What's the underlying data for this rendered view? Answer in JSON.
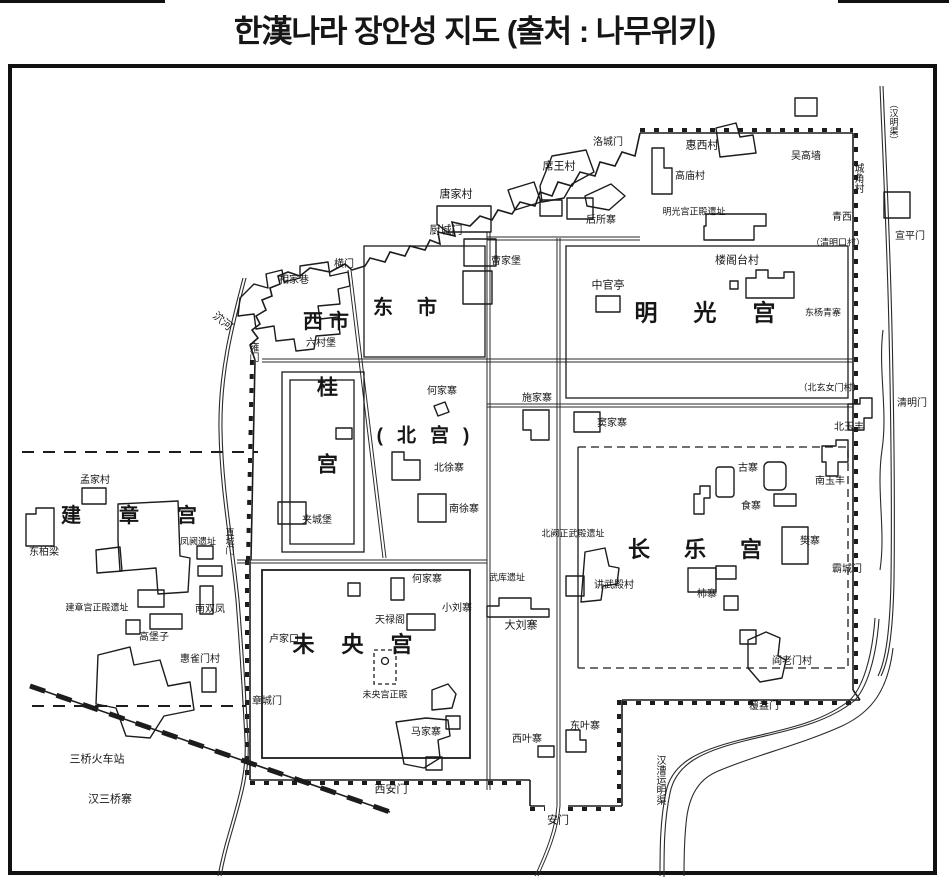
{
  "title": "한漢나라 장안성 지도 (출처 : 나무위키)",
  "colors": {
    "ink": "#1c1c1c",
    "frame": "#111111",
    "background": "#ffffff"
  },
  "map": {
    "labels": [
      {
        "t": "明光宫",
        "x": 723,
        "y": 313,
        "fs": 23,
        "ls": 36,
        "b": 1
      },
      {
        "t": "长乐宫",
        "x": 712,
        "y": 550,
        "fs": 22,
        "ls": 34,
        "b": 1
      },
      {
        "t": "未央宫",
        "x": 366,
        "y": 645,
        "fs": 22,
        "ls": 27,
        "b": 1
      },
      {
        "t": "建章宫",
        "x": 148,
        "y": 516,
        "fs": 20,
        "ls": 38,
        "b": 1
      },
      {
        "t": "(北宫)",
        "x": 430,
        "y": 436,
        "fs": 19,
        "ls": 14,
        "b": 1
      },
      {
        "t": "东市",
        "x": 417,
        "y": 308,
        "fs": 20,
        "ls": 24,
        "b": 1
      },
      {
        "t": "西市",
        "x": 329,
        "y": 322,
        "fs": 20,
        "ls": 6,
        "b": 1
      },
      {
        "t": "桂宫",
        "x": 326,
        "y": 453,
        "fs": 21,
        "ls": 56,
        "b": 1,
        "v": 1
      },
      {
        "t": "（汉明渠）",
        "x": 893,
        "y": 122,
        "fs": 9,
        "v": 1
      },
      {
        "t": "洛城门",
        "x": 608,
        "y": 143,
        "fs": 10
      },
      {
        "t": "惠西村",
        "x": 702,
        "y": 146,
        "fs": 11
      },
      {
        "t": "吴高墙",
        "x": 806,
        "y": 157,
        "fs": 10
      },
      {
        "t": "城角村",
        "x": 857,
        "y": 178,
        "fs": 10,
        "v": 1
      },
      {
        "t": "高庙村",
        "x": 690,
        "y": 177,
        "fs": 10
      },
      {
        "t": "席王村",
        "x": 559,
        "y": 167,
        "fs": 11
      },
      {
        "t": "唐家村",
        "x": 456,
        "y": 195,
        "fs": 11
      },
      {
        "t": "明光宫正殿遗址",
        "x": 694,
        "y": 212,
        "fs": 9
      },
      {
        "t": "后所寨",
        "x": 601,
        "y": 221,
        "fs": 10
      },
      {
        "t": "青西",
        "x": 842,
        "y": 218,
        "fs": 10
      },
      {
        "t": "厨城门",
        "x": 446,
        "y": 231,
        "fs": 11
      },
      {
        "t": "宣平门",
        "x": 910,
        "y": 237,
        "fs": 10
      },
      {
        "t": "（清明口村）",
        "x": 838,
        "y": 243,
        "fs": 9
      },
      {
        "t": "楼阁台村",
        "x": 737,
        "y": 261,
        "fs": 11
      },
      {
        "t": "曹家堡",
        "x": 506,
        "y": 262,
        "fs": 10
      },
      {
        "t": "横门",
        "x": 344,
        "y": 265,
        "fs": 10
      },
      {
        "t": "相家巷",
        "x": 294,
        "y": 281,
        "fs": 10
      },
      {
        "t": "泬河",
        "x": 222,
        "y": 322,
        "fs": 11,
        "rot": 40
      },
      {
        "t": "六村堡",
        "x": 321,
        "y": 344,
        "fs": 10
      },
      {
        "t": "雍门",
        "x": 252,
        "y": 352,
        "fs": 10,
        "v": 1
      },
      {
        "t": "中官亭",
        "x": 608,
        "y": 286,
        "fs": 11
      },
      {
        "t": "东杨青寨",
        "x": 823,
        "y": 313,
        "fs": 9
      },
      {
        "t": "何家寨",
        "x": 442,
        "y": 392,
        "fs": 10
      },
      {
        "t": "施家寨",
        "x": 537,
        "y": 399,
        "fs": 10
      },
      {
        "t": "（北玄女门村）",
        "x": 830,
        "y": 388,
        "fs": 9
      },
      {
        "t": "清明门",
        "x": 912,
        "y": 404,
        "fs": 10
      },
      {
        "t": "窦家寨",
        "x": 612,
        "y": 424,
        "fs": 10
      },
      {
        "t": "北玉丰",
        "x": 849,
        "y": 428,
        "fs": 10
      },
      {
        "t": "北徐寨",
        "x": 449,
        "y": 469,
        "fs": 10
      },
      {
        "t": "南徐寨",
        "x": 464,
        "y": 510,
        "fs": 10
      },
      {
        "t": "夹城堡",
        "x": 317,
        "y": 521,
        "fs": 10
      },
      {
        "t": "古寨",
        "x": 748,
        "y": 469,
        "fs": 10
      },
      {
        "t": "南玉丰",
        "x": 830,
        "y": 482,
        "fs": 10
      },
      {
        "t": "食寨",
        "x": 751,
        "y": 507,
        "fs": 10
      },
      {
        "t": "樊寨",
        "x": 810,
        "y": 542,
        "fs": 10
      },
      {
        "t": "霸城门",
        "x": 847,
        "y": 570,
        "fs": 10
      },
      {
        "t": "讲武殿村",
        "x": 614,
        "y": 586,
        "fs": 10
      },
      {
        "t": "北阙正武殿遗址",
        "x": 573,
        "y": 534,
        "fs": 9
      },
      {
        "t": "柿寨",
        "x": 707,
        "y": 595,
        "fs": 10
      },
      {
        "t": "阎老门村",
        "x": 792,
        "y": 662,
        "fs": 10
      },
      {
        "t": "覆盎门",
        "x": 764,
        "y": 707,
        "fs": 10
      },
      {
        "t": "汉漕运明渠",
        "x": 659,
        "y": 780,
        "fs": 10,
        "v": 1
      },
      {
        "t": "武库遗址",
        "x": 507,
        "y": 578,
        "fs": 9
      },
      {
        "t": "何家寨",
        "x": 427,
        "y": 580,
        "fs": 10
      },
      {
        "t": "小刘寨",
        "x": 457,
        "y": 609,
        "fs": 10
      },
      {
        "t": "天禄阁",
        "x": 390,
        "y": 621,
        "fs": 10
      },
      {
        "t": "大刘寨",
        "x": 521,
        "y": 626,
        "fs": 11
      },
      {
        "t": "卢家口",
        "x": 284,
        "y": 640,
        "fs": 10
      },
      {
        "t": "未央宫正殿",
        "x": 385,
        "y": 695,
        "fs": 9
      },
      {
        "t": "章城门",
        "x": 267,
        "y": 702,
        "fs": 10
      },
      {
        "t": "马家寨",
        "x": 426,
        "y": 733,
        "fs": 10
      },
      {
        "t": "西叶寨",
        "x": 527,
        "y": 740,
        "fs": 10
      },
      {
        "t": "东叶寨",
        "x": 585,
        "y": 727,
        "fs": 10
      },
      {
        "t": "西安门",
        "x": 391,
        "y": 790,
        "fs": 11
      },
      {
        "t": "安门",
        "x": 558,
        "y": 821,
        "fs": 11
      },
      {
        "t": "三桥火车站",
        "x": 97,
        "y": 760,
        "fs": 11
      },
      {
        "t": "汉三桥寨",
        "x": 110,
        "y": 800,
        "fs": 11
      },
      {
        "t": "孟家村",
        "x": 95,
        "y": 481,
        "fs": 10
      },
      {
        "t": "东柏梁",
        "x": 44,
        "y": 553,
        "fs": 10
      },
      {
        "t": "凤阙遗址",
        "x": 198,
        "y": 542,
        "fs": 9
      },
      {
        "t": "直城门",
        "x": 229,
        "y": 541,
        "fs": 9,
        "v": 1
      },
      {
        "t": "建章宫正殿遗址",
        "x": 97,
        "y": 608,
        "fs": 9
      },
      {
        "t": "南双凤",
        "x": 210,
        "y": 610,
        "fs": 10
      },
      {
        "t": "高堡子",
        "x": 154,
        "y": 638,
        "fs": 10
      },
      {
        "t": "惠雀门村",
        "x": 200,
        "y": 660,
        "fs": 10
      }
    ]
  }
}
